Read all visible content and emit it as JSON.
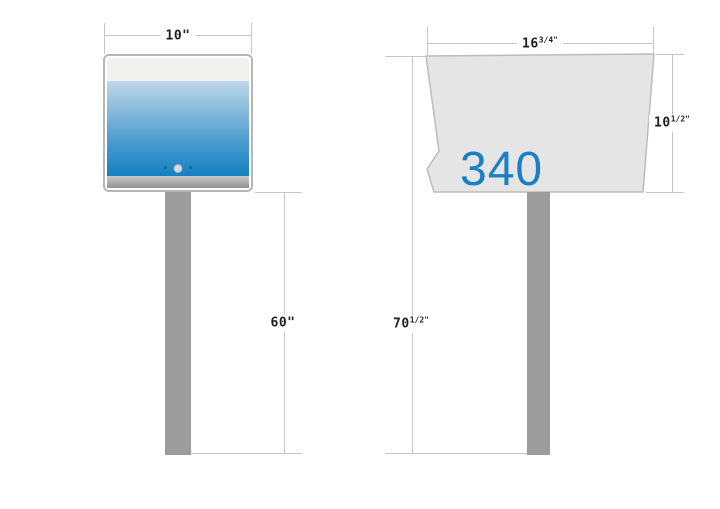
{
  "diagram": {
    "title": "Mailbox and post installation dimensions, front and side views",
    "views": {
      "front": {
        "box_width": {
          "value": "10\"",
          "sup": ""
        },
        "post_height": {
          "value": "60\"",
          "sup": ""
        }
      },
      "side": {
        "box_number": "340",
        "box_width": {
          "value": "16",
          "sup": "3/4\""
        },
        "box_height": {
          "value": "10",
          "sup": "1/2\""
        },
        "total_height": {
          "value": "70",
          "sup": "1/2\""
        }
      }
    },
    "colors": {
      "accent_blue": "#1a7fc4",
      "dim_line_gray": "#c6c6c6",
      "post_gray": "#9c9c9c",
      "body_gray": "#e5e5e5",
      "door_gradient_top": "#bed9ea",
      "door_gradient_bottom": "#1580c2"
    }
  }
}
